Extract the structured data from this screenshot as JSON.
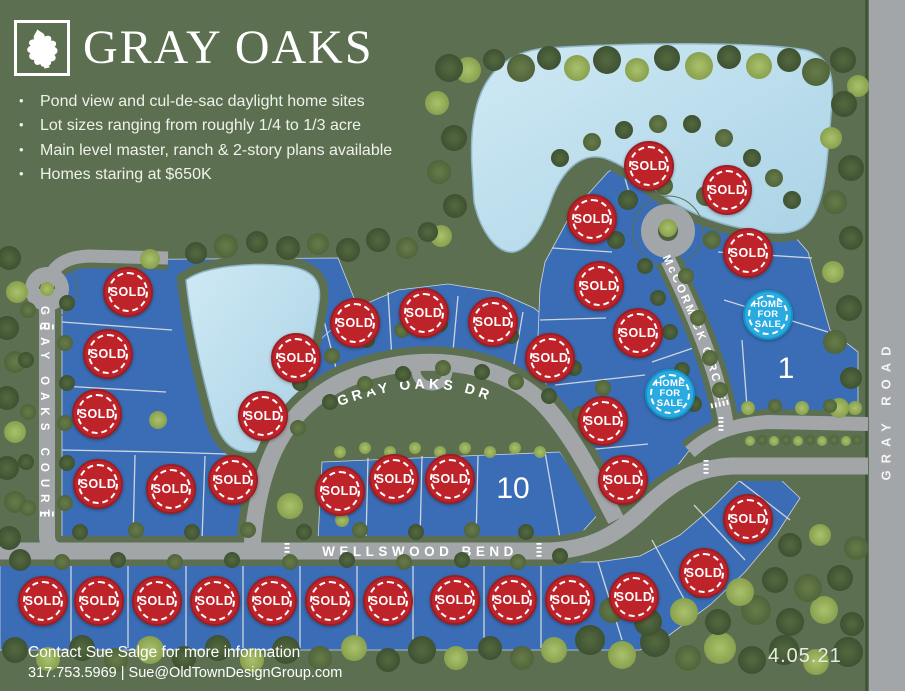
{
  "header": {
    "title": "GRAY OAKS",
    "logo_icon": "oak-leaf-icon",
    "bullets": [
      "Pond view and cul-de-sac daylight home sites",
      "Lot sizes ranging from roughly 1/4 to 1/3 acre",
      "Main level master, ranch & 2-story plans available",
      "Homes staring at $650K"
    ]
  },
  "map": {
    "street_labels": {
      "court": "GRAY OAKS COURT",
      "drive": "GRAY OAKS DR",
      "bend": "WELLSWOOD BEND",
      "circle": "McCORMICK CIRCLE",
      "road": "GRAY ROAD"
    },
    "badge_labels": {
      "sold": "SOLD",
      "for_sale": "HOME FOR SALE"
    },
    "colors": {
      "grass": "#5c7051",
      "lot_blue": "#3a6db5",
      "pond_blue": "#b9dcec",
      "road_gray": "#a3a6a9",
      "sold_red": "#bf232a",
      "for_sale_cyan": "#29abe2"
    },
    "lots": [
      {
        "x": 43,
        "y": 601,
        "status": "sold"
      },
      {
        "x": 99,
        "y": 601,
        "status": "sold"
      },
      {
        "x": 157,
        "y": 601,
        "status": "sold"
      },
      {
        "x": 215,
        "y": 601,
        "status": "sold"
      },
      {
        "x": 272,
        "y": 601,
        "status": "sold"
      },
      {
        "x": 330,
        "y": 601,
        "status": "sold"
      },
      {
        "x": 388,
        "y": 601,
        "status": "sold"
      },
      {
        "x": 455,
        "y": 600,
        "status": "sold"
      },
      {
        "x": 512,
        "y": 600,
        "status": "sold"
      },
      {
        "x": 570,
        "y": 600,
        "status": "sold"
      },
      {
        "x": 634,
        "y": 597,
        "status": "sold"
      },
      {
        "x": 704,
        "y": 573,
        "status": "sold"
      },
      {
        "x": 748,
        "y": 519,
        "status": "sold"
      },
      {
        "x": 98,
        "y": 484,
        "status": "sold"
      },
      {
        "x": 171,
        "y": 489,
        "status": "sold"
      },
      {
        "x": 233,
        "y": 480,
        "status": "sold"
      },
      {
        "x": 97,
        "y": 414,
        "status": "sold"
      },
      {
        "x": 108,
        "y": 354,
        "status": "sold"
      },
      {
        "x": 128,
        "y": 292,
        "status": "sold"
      },
      {
        "x": 263,
        "y": 416,
        "status": "sold"
      },
      {
        "x": 296,
        "y": 358,
        "status": "sold"
      },
      {
        "x": 355,
        "y": 323,
        "status": "sold"
      },
      {
        "x": 424,
        "y": 313,
        "status": "sold"
      },
      {
        "x": 493,
        "y": 322,
        "status": "sold"
      },
      {
        "x": 340,
        "y": 491,
        "status": "sold"
      },
      {
        "x": 394,
        "y": 479,
        "status": "sold"
      },
      {
        "x": 450,
        "y": 479,
        "status": "sold"
      },
      {
        "x": 550,
        "y": 358,
        "status": "sold"
      },
      {
        "x": 592,
        "y": 219,
        "status": "sold"
      },
      {
        "x": 599,
        "y": 286,
        "status": "sold"
      },
      {
        "x": 603,
        "y": 421,
        "status": "sold"
      },
      {
        "x": 623,
        "y": 480,
        "status": "sold"
      },
      {
        "x": 638,
        "y": 333,
        "status": "sold"
      },
      {
        "x": 649,
        "y": 166,
        "status": "sold"
      },
      {
        "x": 727,
        "y": 190,
        "status": "sold"
      },
      {
        "x": 748,
        "y": 253,
        "status": "sold"
      },
      {
        "x": 768,
        "y": 315,
        "status": "for-sale"
      },
      {
        "x": 670,
        "y": 394,
        "status": "for-sale"
      },
      {
        "x": 786,
        "y": 369,
        "status": "available",
        "label": "1"
      },
      {
        "x": 513,
        "y": 489,
        "status": "available",
        "label": "10"
      }
    ]
  },
  "footer": {
    "contact_line1": "Contact Sue Salge for more information",
    "contact_line2": "317.753.5969 | Sue@OldTownDesignGroup.com",
    "date": "4.05.21"
  }
}
